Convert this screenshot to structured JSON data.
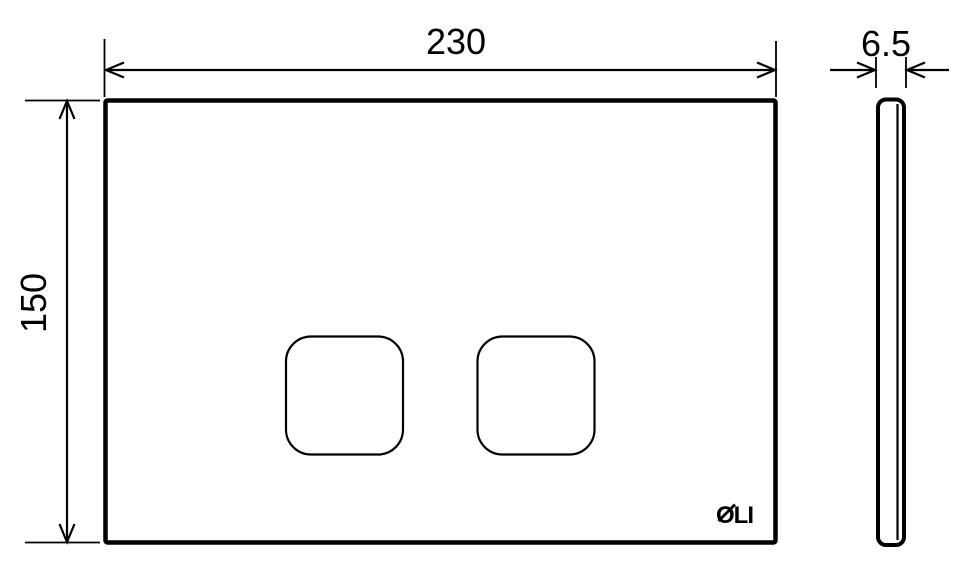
{
  "drawing": {
    "background_color": "#ffffff",
    "line_color": "#000000"
  },
  "front_view": {
    "width_dimension": "230",
    "height_dimension": "150",
    "logo": "OLI"
  },
  "side_view": {
    "thickness_dimension": "6.5"
  }
}
